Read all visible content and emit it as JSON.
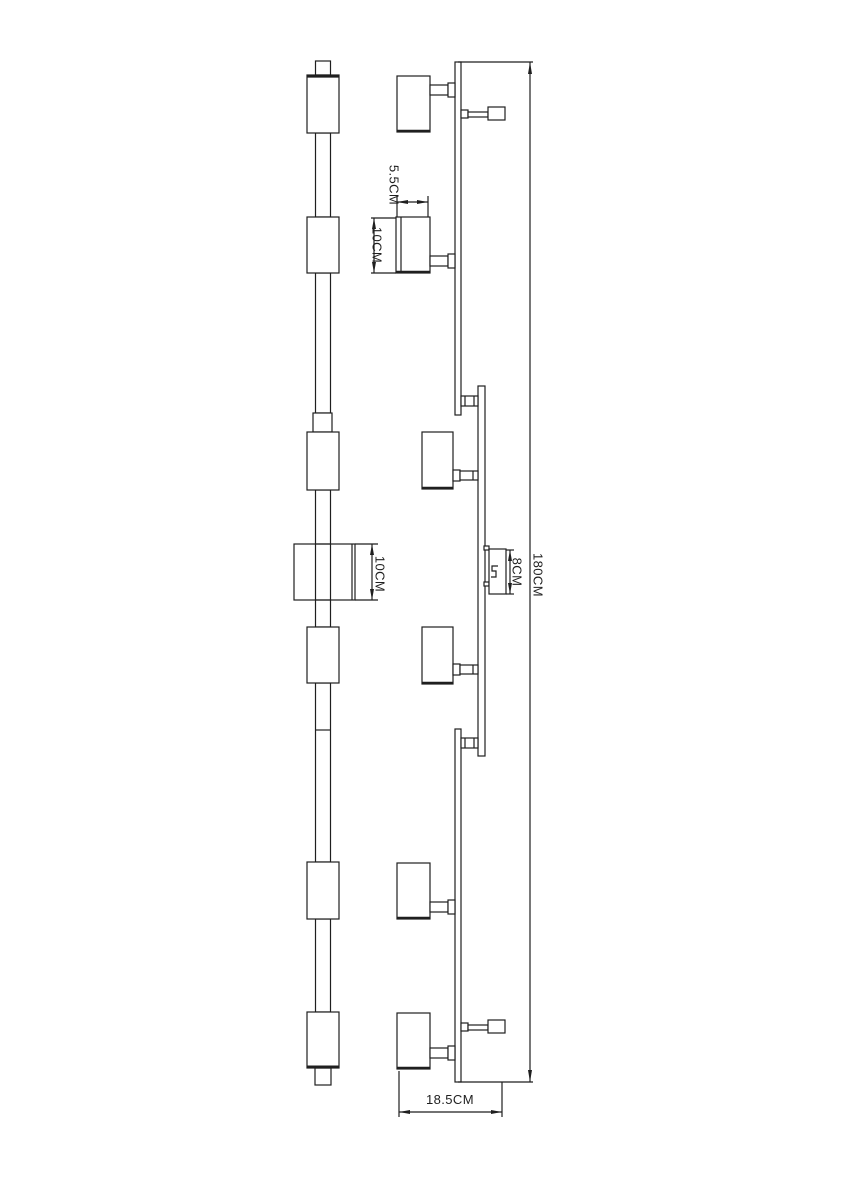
{
  "drawing": {
    "background_color": "#ffffff",
    "line_color": "#1f1f1f",
    "dimensions": {
      "head_depth": "5.5CM",
      "head_height": "10CM",
      "side_bracket_height": "10CM",
      "wall_bracket_height": "8CM",
      "overall_height": "180CM",
      "overall_depth": "18.5CM"
    }
  }
}
